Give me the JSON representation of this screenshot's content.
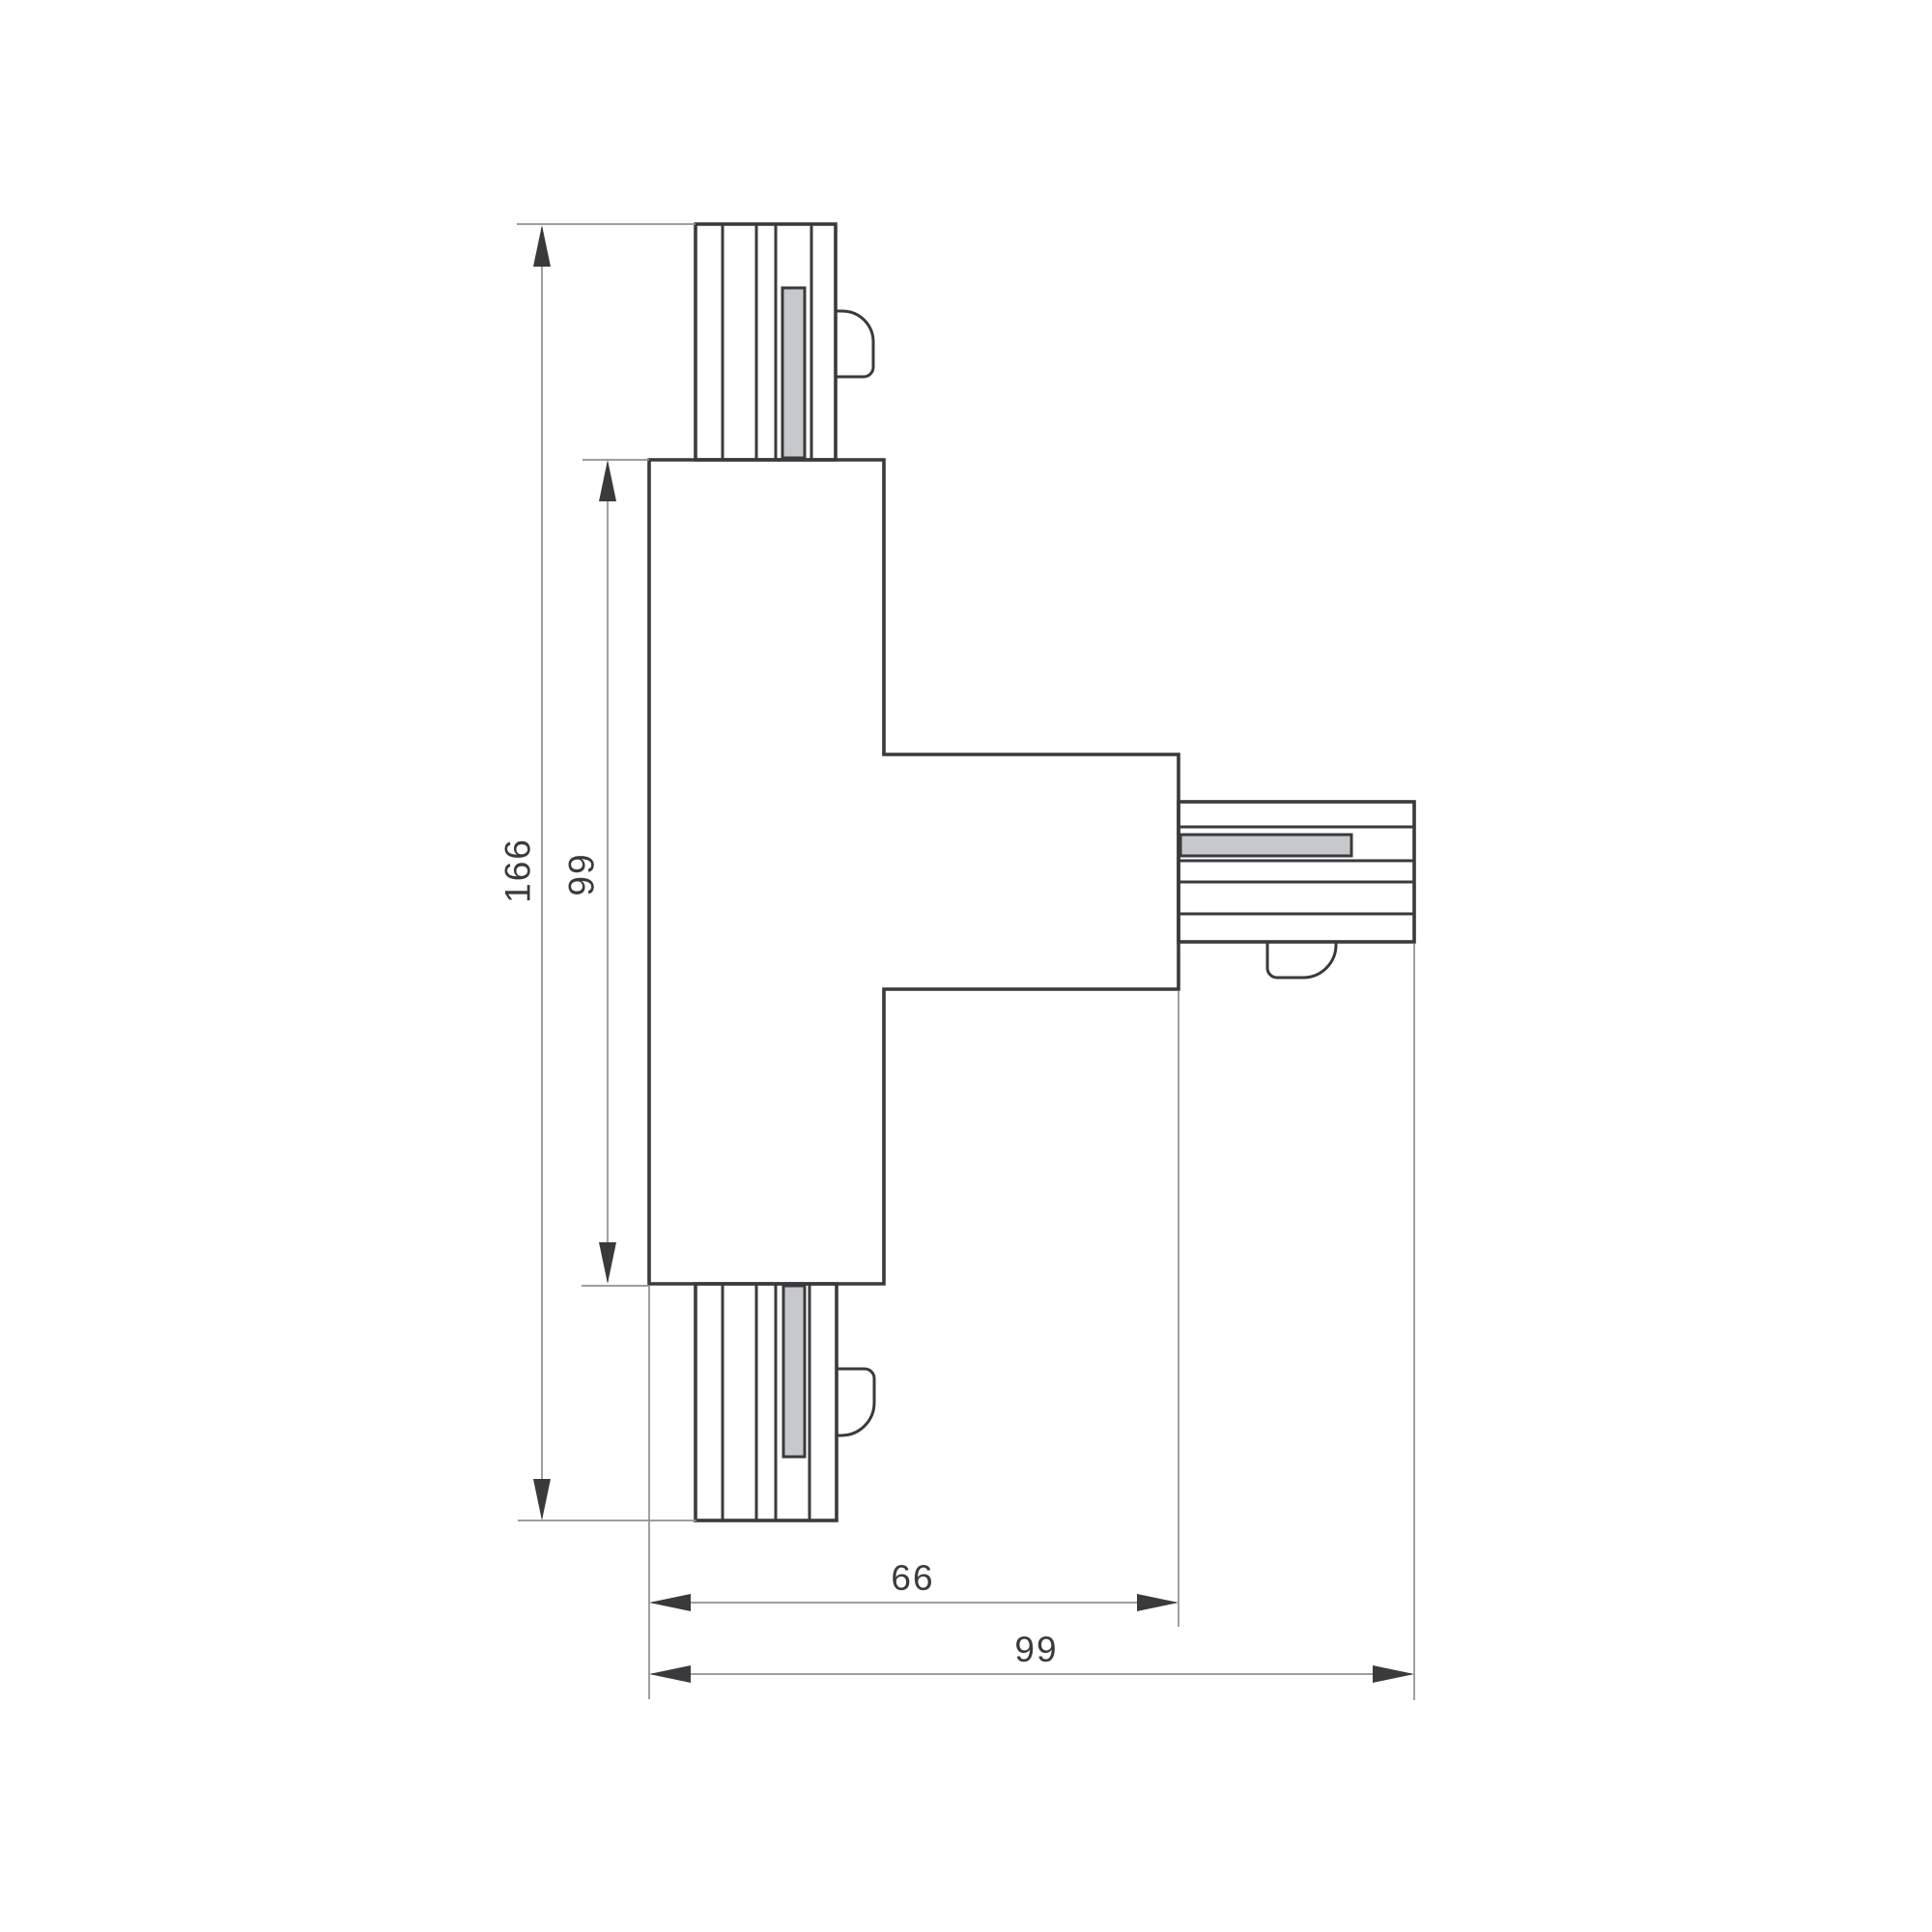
{
  "drawing": {
    "dim_labels": {
      "overall_height": "166",
      "body_height": "99",
      "arm_reach": "66",
      "overall_width": "99"
    },
    "colors": {
      "outline": "#3a3a3c",
      "dim": "#8f9092",
      "arrow": "#3a3a3c",
      "contact_fill": "#c7c8c9",
      "text": "#3a3a3c",
      "background": "#ffffff"
    }
  }
}
